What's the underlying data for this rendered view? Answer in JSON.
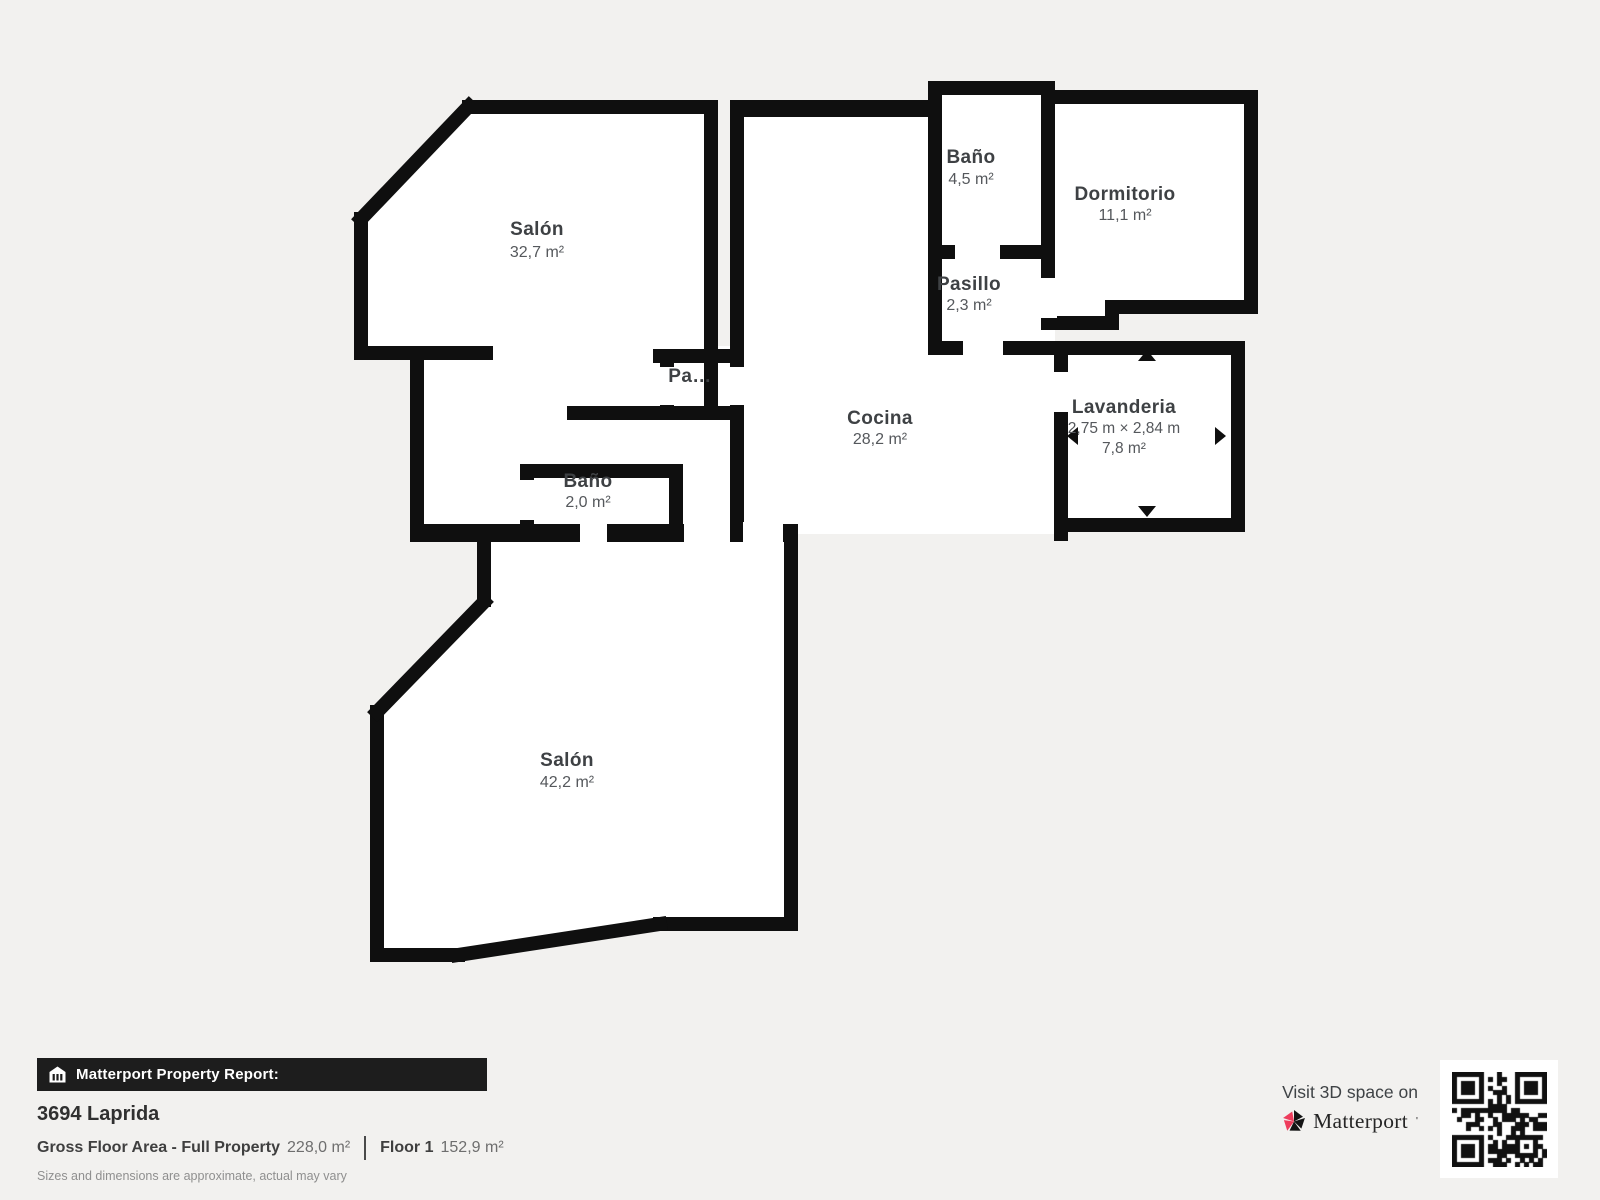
{
  "plan": {
    "rooms": {
      "salon_top": {
        "name": "Salón",
        "area": "32,7 m²"
      },
      "bano_top": {
        "name": "Baño",
        "area": "4,5 m²"
      },
      "dormitorio": {
        "name": "Dormitorio",
        "area": "11,1 m²"
      },
      "pasillo": {
        "name": "Pasillo",
        "area": "2,3 m²"
      },
      "pasillo_small": {
        "name": "Pa…"
      },
      "cocina": {
        "name": "Cocina",
        "area": "28,2 m²"
      },
      "lavanderia": {
        "name": "Lavanderia",
        "dimensions": "2,75 m × 2,84 m",
        "area": "7,8 m²"
      },
      "bano_small": {
        "name": "Baño",
        "area": "2,0 m²"
      },
      "salon_bottom": {
        "name": "Salón",
        "area": "42,2 m²"
      }
    }
  },
  "footer": {
    "report_label": "Matterport Property Report:",
    "property_name": "3694 Laprida",
    "gross_label": "Gross Floor Area - Full Property",
    "gross_value": "228,0 m²",
    "floor_label": "Floor 1",
    "floor_value": "152,9 m²",
    "disclaimer": "Sizes and dimensions are approximate, actual may vary",
    "visit_label": "Visit 3D space on",
    "brand": "Matterport"
  },
  "colors": {
    "background": "#f2f1ef",
    "wall": "#0f0f0f",
    "floor": "#ffffff",
    "accent_pink": "#ee3c5c",
    "bar_background": "#1d1d1d"
  }
}
